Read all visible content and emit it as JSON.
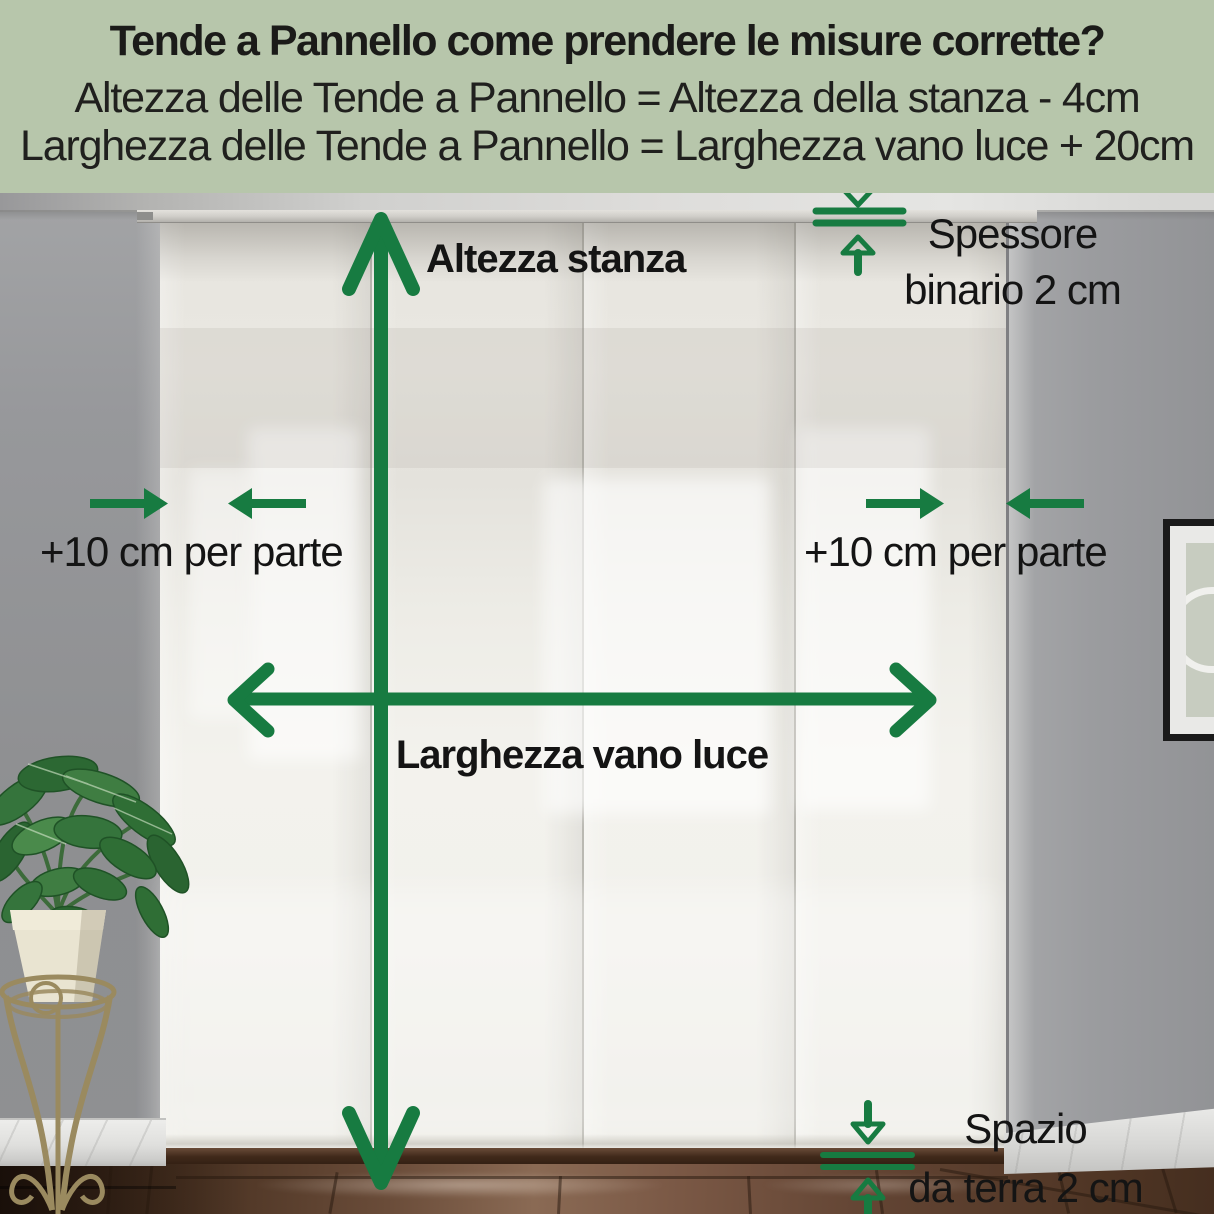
{
  "header": {
    "title": "Tende a Pannello come prendere le misure corrette?",
    "height_formula": "Altezza delle Tende a Pannello = Altezza della stanza - 4cm",
    "width_formula": "Larghezza delle Tende a Pannello = Larghezza vano luce + 20cm"
  },
  "labels": {
    "room_height": "Altezza stanza",
    "opening_width": "Larghezza vano luce",
    "side_margin_left": "+10 cm per parte",
    "side_margin_right": "+10 cm per parte",
    "track_thickness_line1": "Spessore",
    "track_thickness_line2": "binario 2 cm",
    "floor_gap_line1": "Spazio",
    "floor_gap_line2": "da terra 2 cm"
  },
  "icons": {
    "vertical_measure": "double-headed-arrow-vertical",
    "horizontal_measure": "double-headed-arrow-horizontal",
    "side_margins_left": "converging-arrows",
    "side_margins_right": "converging-arrows",
    "track_thickness": "gap-measure-arrows",
    "floor_gap": "gap-measure-arrows"
  },
  "colors": {
    "accent_green": "#177B41",
    "header_background": "#B7C6AB",
    "text_dark": "#161616",
    "wall_gray": "#909194",
    "curtain_white": "#F2F1EC",
    "floor_brown": "#6B4C3A"
  },
  "scene": {
    "curtain_panel_count": "4"
  }
}
